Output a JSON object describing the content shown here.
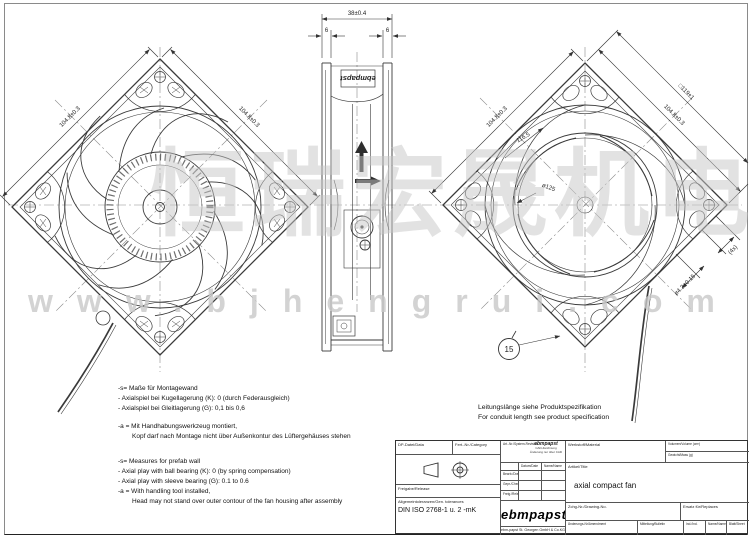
{
  "watermark": {
    "cjk": "恒瑞宏晟机电",
    "url": "www.bjhengrui.com"
  },
  "views": {
    "front": {
      "dim_edge_left": "104.8±0.3",
      "dim_edge_right": "104.8±0.3"
    },
    "side": {
      "dim_depth": "38±0.4",
      "dim_flange_left": "6",
      "dim_flange_right": "6",
      "housing_label": "ebmpapst"
    },
    "rear": {
      "dim_edge_left": "104.8±0.3",
      "dim_hole_pitch": "104.8±0.3",
      "dim_frame": "□119±1",
      "dim_inner": "116.5",
      "dim_circle": "ø125",
      "dim_hole": "ø4.3±0.15",
      "dim_hole_count": "(4x)",
      "balloon": "15"
    }
  },
  "notes_de": [
    "-s= Maße für Montagewand",
    "- Axialspiel bei Kugellagerung (K): 0 (durch Federausgleich)",
    "- Axialspiel bei Gleitlagerung (G): 0,1 bis 0,6",
    "-a = Mit Handhabungswerkzeug montiert,",
    "Kopf darf nach Montage nicht über Außenkontur des Lüftergehäuses stehen"
  ],
  "notes_en": [
    "-s= Measures for prefab wall",
    "- Axial play with ball bearing (K): 0 (by spring compensation)",
    "- Axial play with sleeve bearing (G): 0.1 to 0.6",
    "-a = With handling tool installed,",
    "Head may not stand over outer contour of the fan housing after assembly"
  ],
  "conduit_note_de": "Leitungslänge siehe Produktspezifikation",
  "conduit_note_en": "For conduit length see product specification",
  "titleblock": {
    "dp_file_label": "DP-Datei/Data",
    "prod_label": "Fert.-Nr./Category",
    "release_label": "Freigabe/Release",
    "tol_label": "Allgemeintoleranzen/Gen. tolerances",
    "tol_value": "DIN ISO 2768-1 u. 2 -mK",
    "sysrev_label": "Art.-Nr./System-Revision",
    "mini_logo": "ebmpapst",
    "cad_note_1": "CAD-Zeichnung",
    "cad_note_2": "Änderung nur über CAD",
    "date_header": "Datum/Date",
    "name_header": "Name/Name",
    "row_drawn": "Bearb./Drawn",
    "row_checked": "Gepr./Checked",
    "row_released": "Freig./Released",
    "logo": "ebmpapst",
    "company": "ebm-papst St. Georgen GmbH & Co.KG",
    "material_label": "Werkstoff/Material",
    "volume_label": "Volumen/Volume (cm³)",
    "mass_label": "Gewicht/Mass (g)",
    "title_label": "Artikel/Title",
    "title_value": "axial compact fan",
    "drawing_no_label": "Zchg-Nr./Drawing-No.",
    "replaces_label": "Ersatz für/Replaces",
    "change_label": "Änderungs-Nr/Amendment",
    "bulletin_label": "Mitteilung/Bulletin",
    "index_label": "Ind./Ind.",
    "name_label": "Name/Name",
    "sheet_label": "Blatt/Sheet"
  },
  "colors": {
    "line": "#3a3a3a",
    "dim": "#333333",
    "watermark": "#c7c7c7"
  }
}
